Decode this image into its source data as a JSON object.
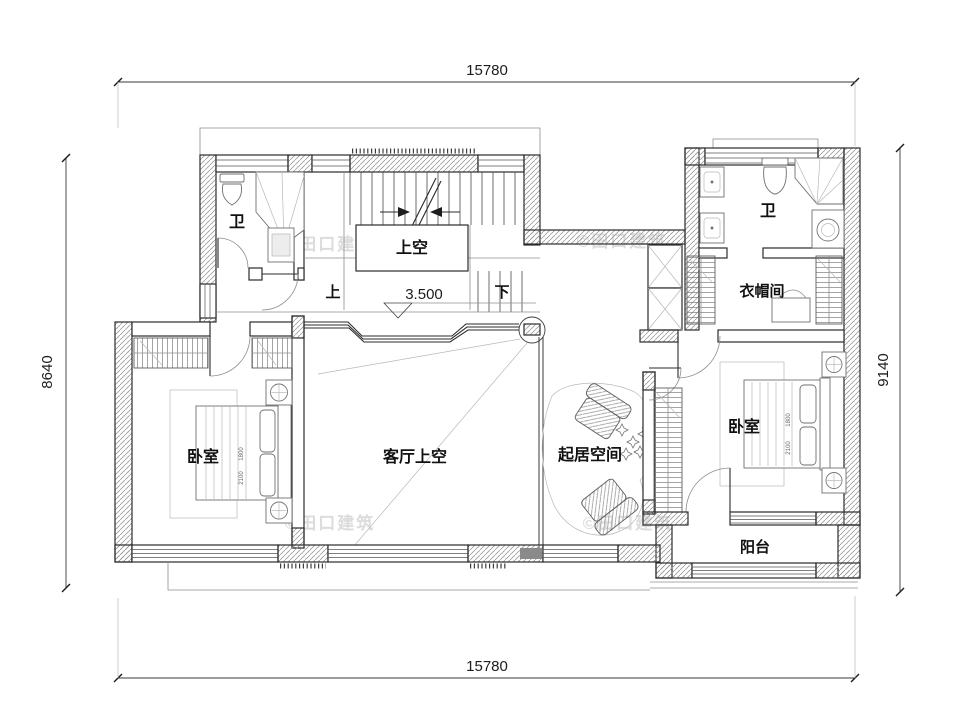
{
  "plan": {
    "watermark": "©田口建筑",
    "dims": {
      "top": "15780",
      "bottom": "15780",
      "left": "8640",
      "right": "9140"
    },
    "elevation": "3.500",
    "stair": {
      "up": "上",
      "down": "下",
      "void": "上空"
    },
    "rooms": {
      "bathLeft": "卫",
      "bathRight": "卫",
      "closet": "衣帽间",
      "bedroomLeft": "卧室",
      "bedroomRight": "卧室",
      "livingVoid": "客厅上空",
      "living": "起居空间",
      "balcony": "阳台"
    },
    "bedDims": {
      "width": "1800",
      "length": "2100"
    }
  }
}
